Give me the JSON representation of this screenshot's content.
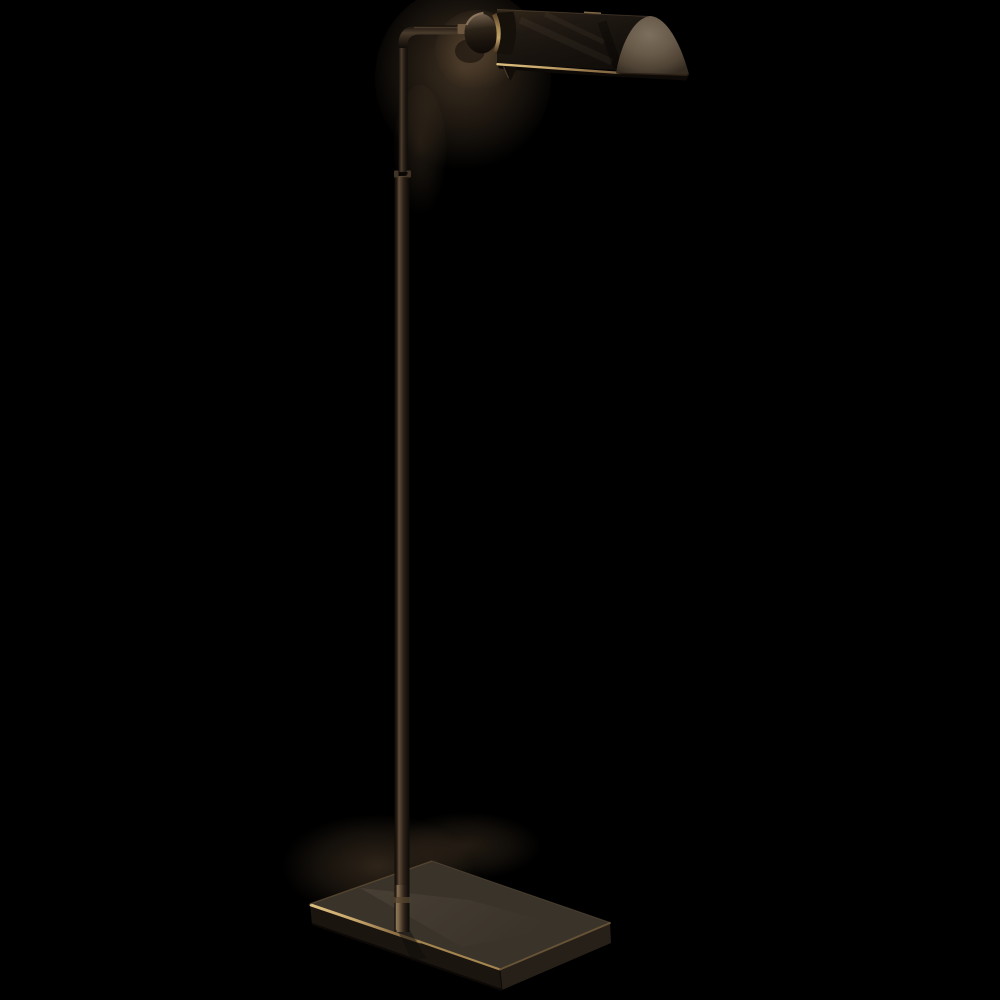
{
  "image": {
    "description": "Product photograph of a pharmacy-style adjustable floor lamp with an angled visor shade, swivel knuckle, thin bronze stem and rectangular plinth base, shown on a solid black background",
    "alt": "Bronze pharmacy floor lamp"
  },
  "colors": {
    "background": "#000000",
    "bronze_dark": "#17120d",
    "bronze_mid": "#3a2f23",
    "bronze_highlight": "#5f4c38",
    "gold_trim_bright": "#ddc07f",
    "gold_trim": "#a98a54",
    "gold_trim_dim": "#7d6440",
    "end_cap_light": "#7d6f5e",
    "end_cap_mid": "#685a49",
    "end_cap_dark": "#352c21",
    "base_top": "#3a332a",
    "base_front": "#241d16",
    "base_right": "#272018",
    "glow_warm": "#7a5f42"
  },
  "parts": {
    "shade": "visor shade",
    "end_cap": "shade end cap",
    "knuckle": "swivel knuckle",
    "arm": "angled arm",
    "upper_stem": "upper stem rod",
    "joint": "stem adjustment joint",
    "lower_stem": "lower stem tube",
    "base": "rectangular base"
  }
}
